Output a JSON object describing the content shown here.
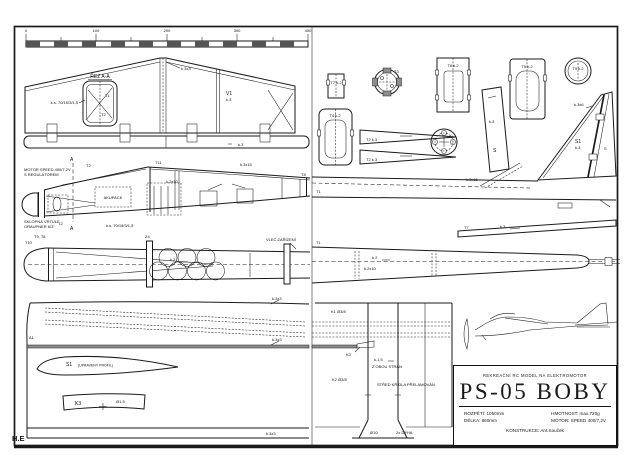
{
  "meta": {
    "ink": "#1a1a1a",
    "paper": "#ffffff",
    "band": "#8d8d8d"
  },
  "watermark": "H.E",
  "scale_bar": {
    "ticks": [
      "0",
      "100",
      "200",
      "300",
      "400"
    ]
  },
  "title_block": {
    "header": "REKREAČNÍ RC MODEL NA ELEKTROMOTOR",
    "title": "PS-05 BOBY",
    "specs_left": [
      {
        "label": "ROZPĚTÍ:",
        "value": "1050mm"
      },
      {
        "label": "DÉLKA:",
        "value": "860mm"
      }
    ],
    "specs_right": [
      {
        "label": "HMOTNOST:",
        "value": "max.720g"
      },
      {
        "label": "MOTOR:",
        "value": "SPEED 400/7,2V"
      }
    ],
    "designer_label": "KONSTRUKCE:",
    "designer_value": "Ant.Souček"
  },
  "labels": {
    "rez_aa": "ŘEZ A-A",
    "t1": "T1",
    "t2": "T2",
    "t3": "T3",
    "t8": "T8",
    "t9_t8": "T9, T8",
    "t10": "T10",
    "t11": "T11",
    "v1": "V1",
    "k3": "k.3",
    "k2": "k.2",
    "k3x3": "k.3x3",
    "k3x15": "k.3x15",
    "k2x10": "k.2x10",
    "rib_note": "k.s. 70/15/3/1,5",
    "motor_note_1": "MOTOR SPEED 400/7,2V",
    "motor_note_2": "S REGULÁTOREM",
    "prop_note_1": "SKLOPNÁ VRTULE",
    "prop_note_2": "GRAUPNER 6/3\"",
    "akupack": "AKUPACK",
    "z4": "Z4",
    "tow_note": "VLEČ.ZAŘÍZENÍ",
    "t7_former": "T7 k.2",
    "t4_former": "T4 k.2",
    "t5_former": "T5 k.2",
    "t6_former": "T6 k.2",
    "t9_former": "T9 k.2",
    "t2_wedge": "T2 k.3",
    "s_spar": "S",
    "s1_fin": "S1",
    "s_rudder": "S",
    "fin_note": "k.3x6",
    "t7_elev": "T7",
    "a_marker": "A",
    "a1": "A1",
    "s1_profile": "S1",
    "s1_profile_note": "(UPRAVENÝ PROFIL)",
    "k3_part": "K3",
    "k3_dia": "Ø1,5",
    "k1_rod": "K1 Ø3/8",
    "k2_rod": "K2 Ø3/8",
    "k15": "k.1,5",
    "both_sides": "Z OBOU STRAN",
    "center_note": "STŘED KŘÍDLA PŘELAMOVÁN",
    "dia10": "Ø10",
    "dyha": "2x DÝHA"
  }
}
